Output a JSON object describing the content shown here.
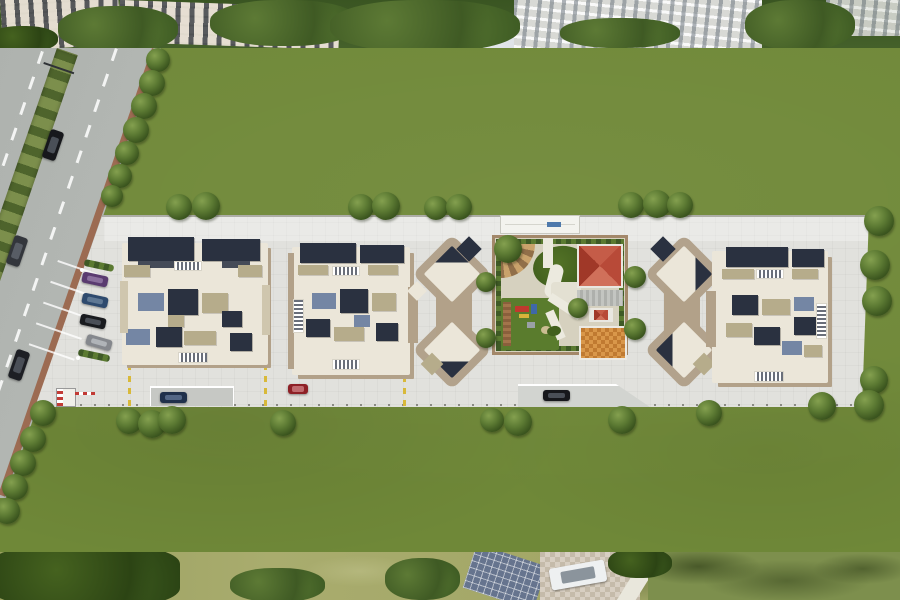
{
  "meta": {
    "label": "Aerial 3D master-plan render of a residential complex: main road with median on the left, central paved podium with three apartment tower clusters, landscaped amenity courtyard with clubhouse and playground, lawns and perimeter trees"
  },
  "palette": {
    "lawn": "#6f8838",
    "plaza_concrete": "#e1e1dd",
    "road_asphalt": "#b9bdb9",
    "curb_brown": "#9c6b52",
    "roof_dark_navy": "#2a3140",
    "roof_cream": "#ebe6d9",
    "roof_khaki": "#b6ac8b",
    "roof_slate_blue": "#7486a4",
    "podium_tan": "#b2a189",
    "amenity_red_roof": "#b84a38",
    "amenity_orange_paver": "#d1913f",
    "playground_green": "#5a7c2d",
    "marking_yellow": "#d8b93a",
    "tree_green": "#3c561f"
  },
  "scene": {
    "trees": [
      {
        "x": 166,
        "y": 194,
        "d": 26
      },
      {
        "x": 192,
        "y": 192,
        "d": 28
      },
      {
        "x": 348,
        "y": 194,
        "d": 26
      },
      {
        "x": 372,
        "y": 192,
        "d": 28
      },
      {
        "x": 424,
        "y": 196,
        "d": 24
      },
      {
        "x": 446,
        "y": 194,
        "d": 26
      },
      {
        "x": 618,
        "y": 192,
        "d": 26
      },
      {
        "x": 643,
        "y": 190,
        "d": 28
      },
      {
        "x": 667,
        "y": 192,
        "d": 26
      },
      {
        "x": 864,
        "y": 206,
        "d": 30
      },
      {
        "x": 860,
        "y": 250,
        "d": 30
      },
      {
        "x": 862,
        "y": 286,
        "d": 30
      },
      {
        "x": 860,
        "y": 366,
        "d": 28
      },
      {
        "x": 854,
        "y": 390,
        "d": 30
      },
      {
        "x": 808,
        "y": 392,
        "d": 28
      },
      {
        "x": 116,
        "y": 408,
        "d": 26
      },
      {
        "x": 138,
        "y": 410,
        "d": 28
      },
      {
        "x": 158,
        "y": 406,
        "d": 28
      },
      {
        "x": 270,
        "y": 410,
        "d": 26
      },
      {
        "x": 480,
        "y": 408,
        "d": 24
      },
      {
        "x": 504,
        "y": 408,
        "d": 28
      },
      {
        "x": 608,
        "y": 406,
        "d": 28
      },
      {
        "x": 696,
        "y": 400,
        "d": 26
      },
      {
        "x": 30,
        "y": 400,
        "d": 26
      },
      {
        "x": 20,
        "y": 426,
        "d": 26
      },
      {
        "x": 10,
        "y": 450,
        "d": 26
      },
      {
        "x": 2,
        "y": 474,
        "d": 26
      },
      {
        "x": -6,
        "y": 498,
        "d": 26
      },
      {
        "x": 146,
        "y": 48,
        "d": 24
      },
      {
        "x": 139,
        "y": 70,
        "d": 26
      },
      {
        "x": 131,
        "y": 93,
        "d": 26
      },
      {
        "x": 123,
        "y": 117,
        "d": 26
      },
      {
        "x": 115,
        "y": 141,
        "d": 24
      },
      {
        "x": 108,
        "y": 164,
        "d": 24
      },
      {
        "x": 101,
        "y": 185,
        "d": 22
      },
      {
        "x": 476,
        "y": 272,
        "d": 20
      },
      {
        "x": 476,
        "y": 328,
        "d": 20
      },
      {
        "x": 624,
        "y": 266,
        "d": 22
      },
      {
        "x": 624,
        "y": 318,
        "d": 22
      },
      {
        "x": 494,
        "y": 235,
        "d": 28
      },
      {
        "x": 568,
        "y": 298,
        "d": 20
      }
    ],
    "cars": [
      {
        "x": 46,
        "y": 130,
        "w": 14,
        "h": 30,
        "rot": 19,
        "body": "#17181c",
        "glass": "#4a4f57"
      },
      {
        "x": 10,
        "y": 236,
        "w": 14,
        "h": 30,
        "rot": 19,
        "body": "#33363c",
        "glass": "#585d65"
      },
      {
        "x": 12,
        "y": 350,
        "w": 14,
        "h": 30,
        "rot": 19,
        "body": "#1d1f24",
        "glass": "#4a4f57"
      },
      {
        "x": 82,
        "y": 274,
        "w": 26,
        "h": 11,
        "rot": 12,
        "body": "#5a3b70",
        "glass": "#8a6f9d"
      },
      {
        "x": 82,
        "y": 295,
        "w": 26,
        "h": 11,
        "rot": 12,
        "body": "#2e4a6e",
        "glass": "#5f7894"
      },
      {
        "x": 80,
        "y": 316,
        "w": 26,
        "h": 11,
        "rot": 12,
        "body": "#191b1f",
        "glass": "#4a4f57"
      },
      {
        "x": 86,
        "y": 337,
        "w": 26,
        "h": 11,
        "rot": 16,
        "body": "#85888d",
        "glass": "#b0b4b8"
      },
      {
        "x": 288,
        "y": 384,
        "w": 20,
        "h": 10,
        "rot": 0,
        "body": "#8e2026",
        "glass": "#c06a6e"
      },
      {
        "x": 160,
        "y": 392,
        "w": 27,
        "h": 11,
        "rot": 0,
        "body": "#20304b",
        "glass": "#536685"
      },
      {
        "x": 543,
        "y": 390,
        "w": 27,
        "h": 11,
        "rot": 0,
        "body": "#17181c",
        "glass": "#4a4f57"
      },
      {
        "x": 550,
        "y": 564,
        "w": 56,
        "h": 22,
        "rot": -10,
        "body": "#eef0f1",
        "glass": "#8b949c"
      }
    ]
  }
}
